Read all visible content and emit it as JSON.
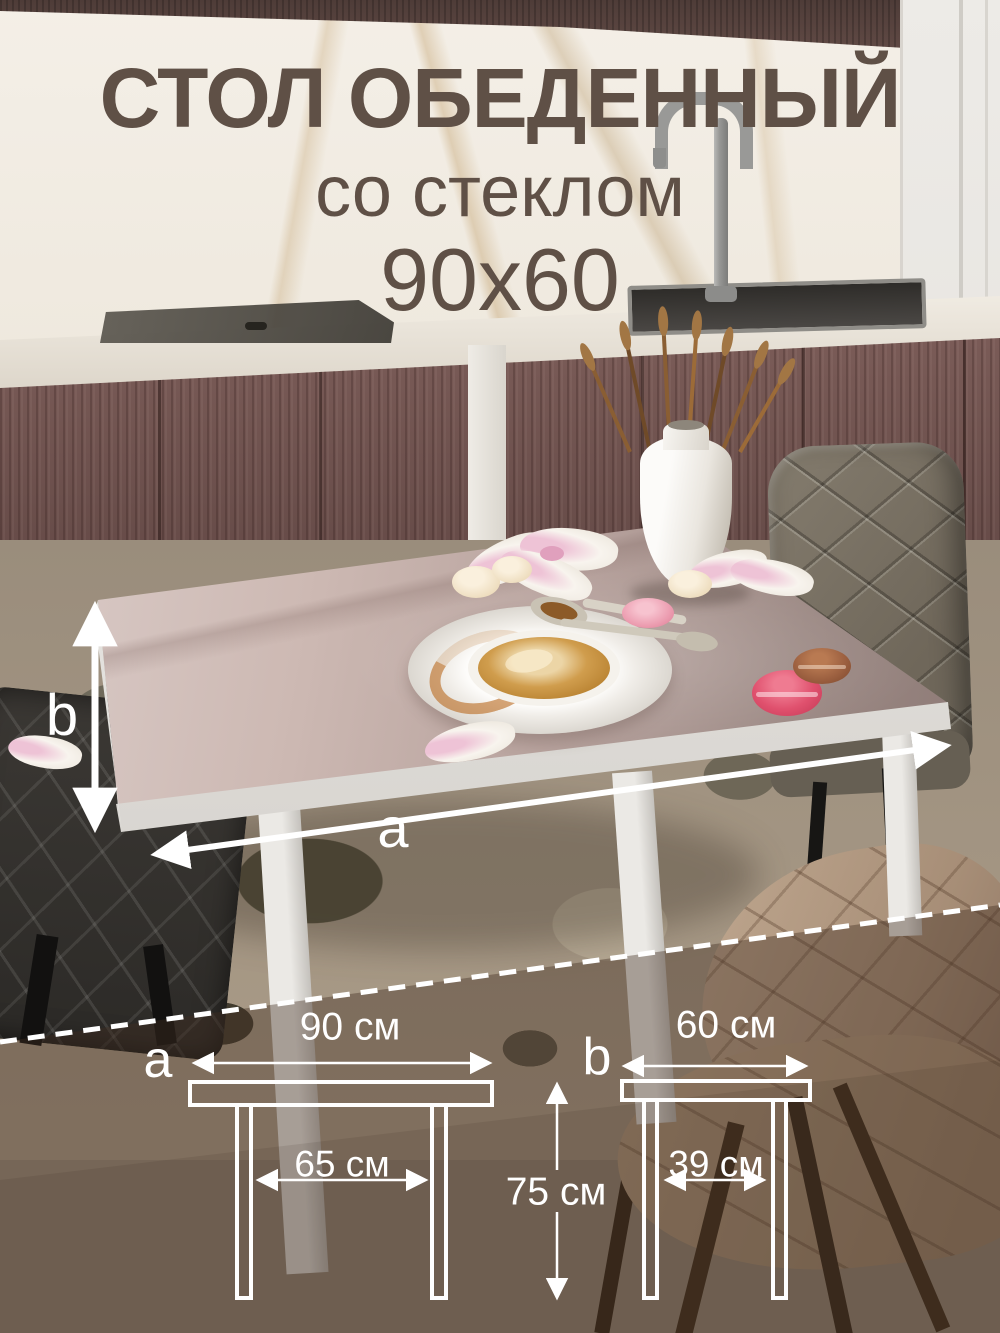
{
  "title": {
    "line1": "СТОЛ ОБЕДЕННЫЙ",
    "line2": "со стеклом",
    "line3": "90х60"
  },
  "photo_labels": {
    "width": "a",
    "depth": "b"
  },
  "diagram": {
    "front_view": {
      "label": "a",
      "top_width": "90 см",
      "leg_span": "65 см"
    },
    "side_view": {
      "label": "b",
      "top_width": "60 см",
      "leg_span": "39 см"
    },
    "height": "75 см"
  },
  "colors": {
    "title_text": "#5f5046",
    "annotation_white": "#ffffff",
    "overlay_brown": "rgba(64,46,33,0.40)",
    "macaron_pink_accent": "#e0516e"
  }
}
